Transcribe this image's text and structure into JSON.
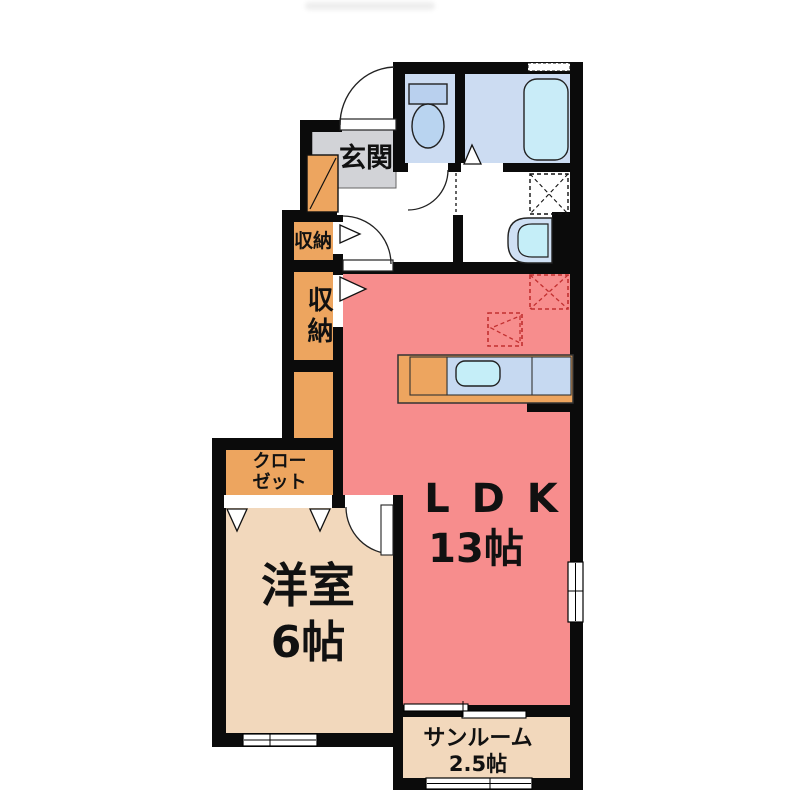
{
  "plan_title": "1LDK floor plan",
  "rooms": {
    "entrance": {
      "label": "玄関"
    },
    "storage_upper": {
      "label": "収納"
    },
    "storage_lower": {
      "label": "収納"
    },
    "closet": {
      "label": [
        "クロー",
        "ゼット"
      ]
    },
    "western_room": {
      "label": "洋室",
      "size": "6帖"
    },
    "ldk": {
      "label": "L D K",
      "size": "13帖"
    },
    "sunroom": {
      "label": "サンルーム",
      "size": "2.5帖"
    }
  },
  "fixtures": [
    "toilet",
    "bathtub",
    "bath-folding-door",
    "washing-machine-space",
    "washbasin",
    "kitchen-counter",
    "kitchen-sink",
    "refrigerator-space",
    "cupboard-space",
    "closet-folding-doors",
    "shoe-cabinet"
  ],
  "colors": {
    "wall": "#0b0b0b",
    "ldk_floor": "#f78d8d",
    "tatami_rooms_floor": "#f2d8bc",
    "storage_orange": "#eda55f",
    "entrance_gray": "#d2d3d7",
    "wet_area_blue": "#ccdcf2",
    "fixture_blue": "#b9d0ee",
    "water_cyan": "#c5eef8",
    "counter_top_blue": "#c6d9f1",
    "appliance_dash_red": "#c23030",
    "text": "#111111"
  }
}
